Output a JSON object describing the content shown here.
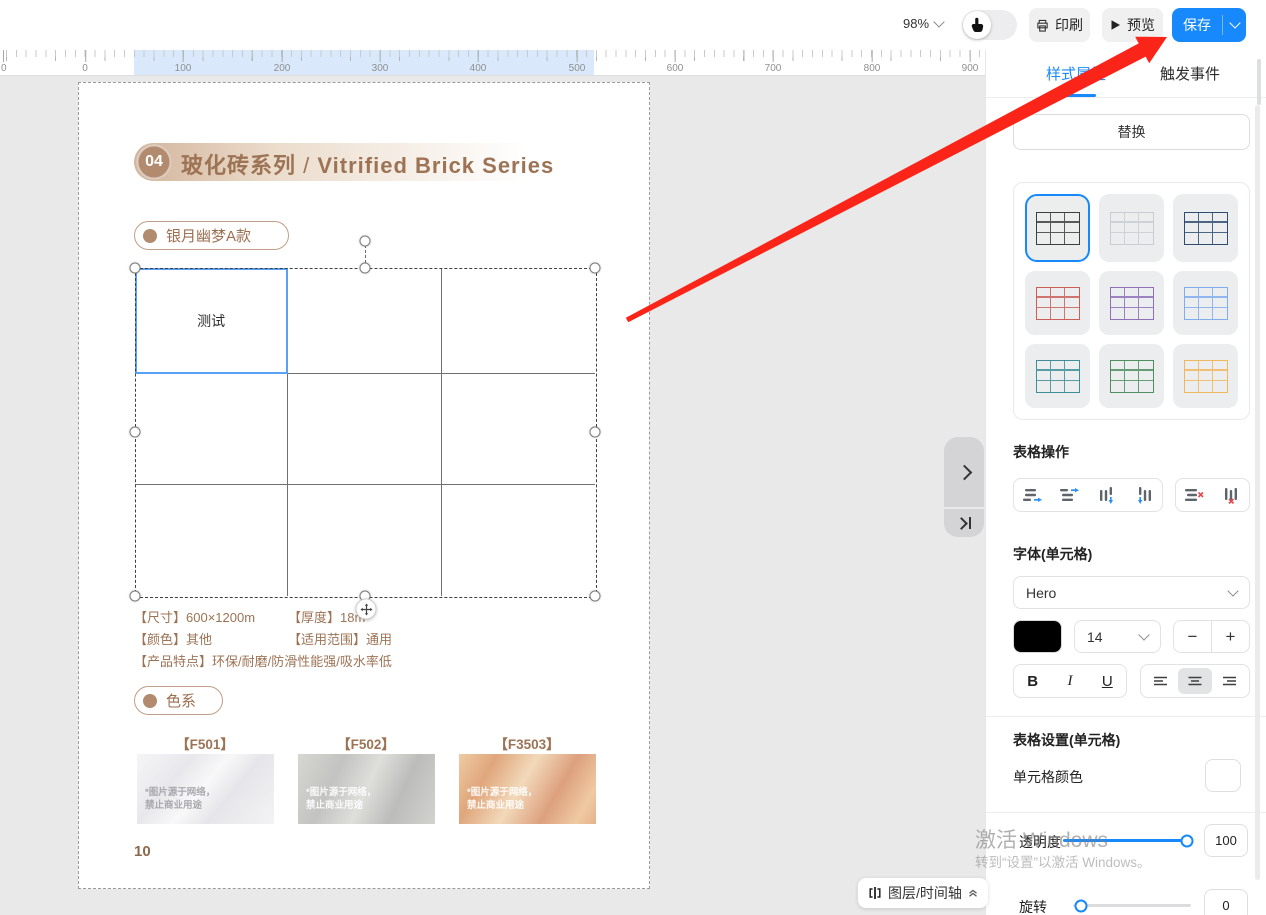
{
  "toolbar": {
    "zoom_level": "98%",
    "print_label": "印刷",
    "preview_label": "预览",
    "save_label": "保存"
  },
  "ruler": {
    "edge_label": "0",
    "labels": [
      "0",
      "100",
      "200",
      "300",
      "400",
      "500",
      "600",
      "700",
      "800",
      "900"
    ]
  },
  "page": {
    "title_number": "04",
    "title_zh": "玻化砖系列",
    "title_sep": "/",
    "title_en": "Vitrified Brick Series",
    "series_badge": "银月幽梦A款",
    "table_cell_text": "测试",
    "specs": {
      "s1k": "【尺寸】",
      "s1v": "600×1200m",
      "s2k": "【厚度】",
      "s2v": "18m",
      "s3k": "【颜色】",
      "s3v": "其他",
      "s4k": "【适用范围】",
      "s4v": "通用",
      "s5k": "【产品特点】",
      "s5v": "环保/耐磨/防滑性能强/吸水率低"
    },
    "color_badge": "色系",
    "swatches": [
      {
        "code": "【F501】"
      },
      {
        "code": "【F502】"
      },
      {
        "code": "【F3503】"
      }
    ],
    "swatch_wm1": "*图片源于网络，",
    "swatch_wm2": "禁止商业用途",
    "page_number": "10"
  },
  "canvas": {
    "layers_button": "图层/时间轴"
  },
  "panel": {
    "tab_style": "样式属性",
    "tab_trigger": "触发事件",
    "replace_button": "替换",
    "style_colors": [
      "#3f3f3f",
      "#c9cdd2",
      "#2f4d6e",
      "#cb5f58",
      "#8f6fb8",
      "#7fadee",
      "#3f8e99",
      "#4f8f5f",
      "#f0b85e"
    ],
    "ops_title": "表格操作",
    "font_title": "字体(单元格)",
    "font_name": "Hero",
    "font_size": "14",
    "minus": "−",
    "plus": "+",
    "bold": "B",
    "italic": "I",
    "underline": "U",
    "settings_title": "表格设置(单元格)",
    "cell_color_label": "单元格颜色",
    "opacity_label": "透明度",
    "opacity_value": "100",
    "rotate_label": "旋转",
    "rotate_value": "0",
    "accent_color": "#1789fc"
  },
  "watermark": {
    "line1": "激活 Windows",
    "line2": "转到“设置”以激活 Windows。"
  }
}
